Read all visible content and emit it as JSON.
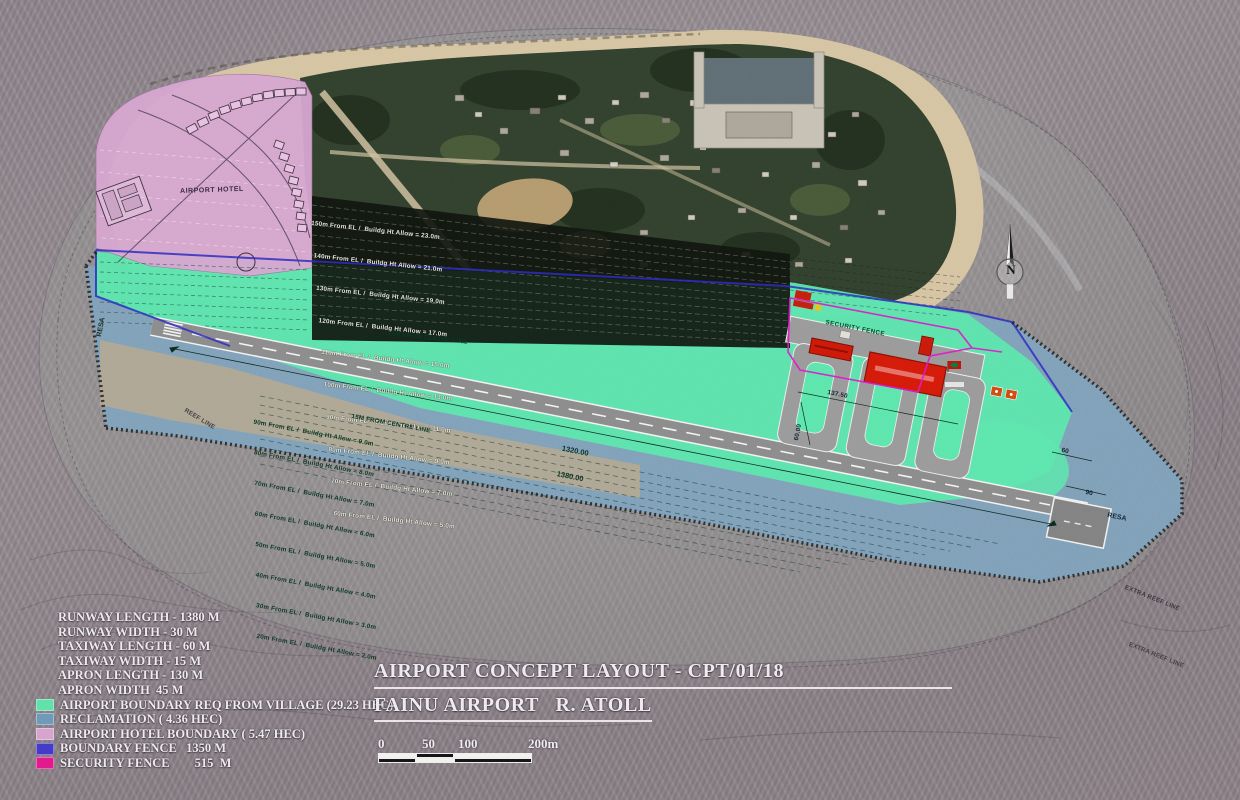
{
  "title": {
    "line1": "AIRPORT CONCEPT LAYOUT - CPT/01/18",
    "line2": "FAINU AIRPORT   R. ATOLL"
  },
  "scale": {
    "ticks": [
      "0",
      "50",
      "100",
      "200m"
    ]
  },
  "north": {
    "label": "N"
  },
  "legend": {
    "specs": [
      "RUNWAY LENGTH - 1380 M",
      "RUNWAY WIDTH - 30 M",
      "TAXIWAY LENGTH - 60 M",
      "TAXIWAY WIDTH - 15 M",
      "APRON LENGTH - 130 M",
      "APRON WIDTH  45 M"
    ],
    "areas": [
      {
        "label": "AIRPORT BOUNDARY REQ FROM VILLAGE (29.23 HEC)",
        "color": "#5fe0aa"
      },
      {
        "label": "RECLAMATION ( 4.36 HEC)",
        "color": "#6e98b6"
      },
      {
        "label": "AIRPORT HOTEL BOUNDARY ( 5.47 HEC)",
        "color": "#d6a2cf"
      },
      {
        "label": "BOUNDARY FENCE   1350 M",
        "color": "#4238c8"
      },
      {
        "label": "SECURITY FENCE        515  M",
        "color": "#e0188c"
      }
    ]
  },
  "map": {
    "hotel_label": "AIRPORT HOTEL",
    "security_fence_label": "SECURITY FENCE",
    "resa": "RESA",
    "centerline_note": "15M FROM CENTRE LINE",
    "reef_line": "REEF LINE",
    "extra_reef_line": "EXTRA REEF LINE",
    "dims": {
      "runway_a": "1320.00",
      "runway_b": "1380.00",
      "apron": "137.50",
      "taxiway": "60.00",
      "end_a": "60",
      "end_b": "90"
    },
    "height_lines_top": [
      "150m From EL /  Buildg Ht Allow = 23.0m",
      "140m From EL /  Buildg Ht Allow = 21.0m",
      "130m From EL /  Buildg Ht Allow = 19.0m",
      "120m From EL /  Buildg Ht Allow = 17.0m",
      "110m From EL /  Buildg Ht Allow = 15.0m",
      "100m From EL /  Buildg Ht Allow = 13.0m",
      "90m From EL /  Buildg Ht Allow = 11.0m",
      "80m From EL /  Buildg Ht Allow = 9.0m",
      "70m From EL /  Buildg Ht Allow = 7.0m",
      "60m From EL /  Buildg Ht Allow = 5.0m"
    ],
    "height_lines_bottom": [
      "90m From EL /  Buildg Ht Allow = 9.0m",
      "80m From EL /  Buildg Ht Allow = 8.0m",
      "70m From EL /  Buildg Ht Allow = 7.0m",
      "60m From EL /  Buildg Ht Allow = 6.0m",
      "50m From EL /  Buildg Ht Allow = 5.0m",
      "40m From EL /  Buildg Ht Allow = 4.0m",
      "30m From EL /  Buildg Ht Allow = 3.0m",
      "20m From EL /  Buildg Ht Allow = 2.0m"
    ]
  }
}
